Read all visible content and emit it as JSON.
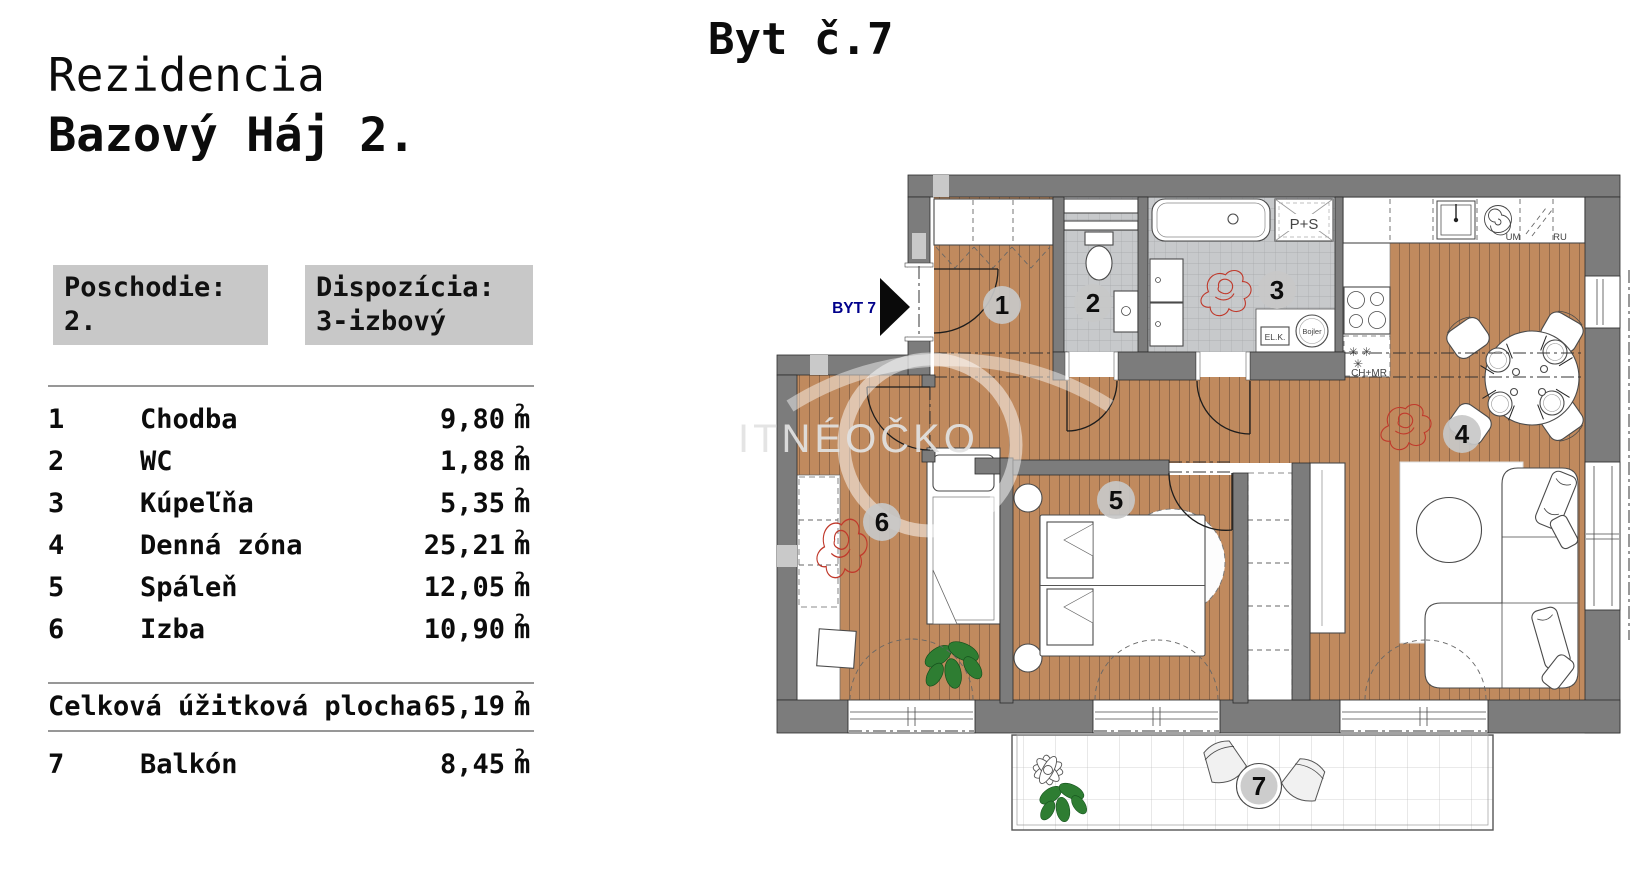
{
  "panel": {
    "title_line1": "Rezidencia",
    "title_line2": "Bazový Háj 2.",
    "floor_box": {
      "label": "Poschodie:",
      "value": "2."
    },
    "layout_box": {
      "label": "Dispozícia:",
      "value": "3-izbový"
    },
    "unit": {
      "base": "m",
      "sup": "2"
    },
    "rooms": [
      {
        "num": "1",
        "name": "Chodba",
        "area": "9,80"
      },
      {
        "num": "2",
        "name": "WC",
        "area": "1,88"
      },
      {
        "num": "3",
        "name": "Kúpeľňa",
        "area": "5,35"
      },
      {
        "num": "4",
        "name": "Denná zóna",
        "area": "25,21"
      },
      {
        "num": "5",
        "name": "Spáleň",
        "area": "12,05"
      },
      {
        "num": "6",
        "name": "Izba",
        "area": "10,90"
      }
    ],
    "total": {
      "label": "Celková úžitková plocha",
      "area": "65,19"
    },
    "balcony": {
      "num": "7",
      "name": "Balkón",
      "area": "8,45"
    }
  },
  "plan": {
    "title": "Byt č.7",
    "entry_label": "BYT 7",
    "watermark": "ITNÉOČKO",
    "labels": {
      "ps": "P+S",
      "elk": "EL.K.",
      "bojler": "Bojler",
      "um": "UM",
      "ru": "RU",
      "chmr": "CH+MR",
      "snow_row1": "✳ ✳",
      "snow_row2": "✳"
    },
    "colors": {
      "wall": "#7c7c7c",
      "wall_light": "#c9c9c9",
      "wood": "#c08a5e",
      "wood_line": "#6f5139",
      "tile": "#c7c9cb",
      "tile_line": "#a6a8aa",
      "badge": "#c8c8c8",
      "entry_accent": "#00008b",
      "plant_green": "#2e7d32",
      "scribble_red": "#c0392b"
    }
  }
}
